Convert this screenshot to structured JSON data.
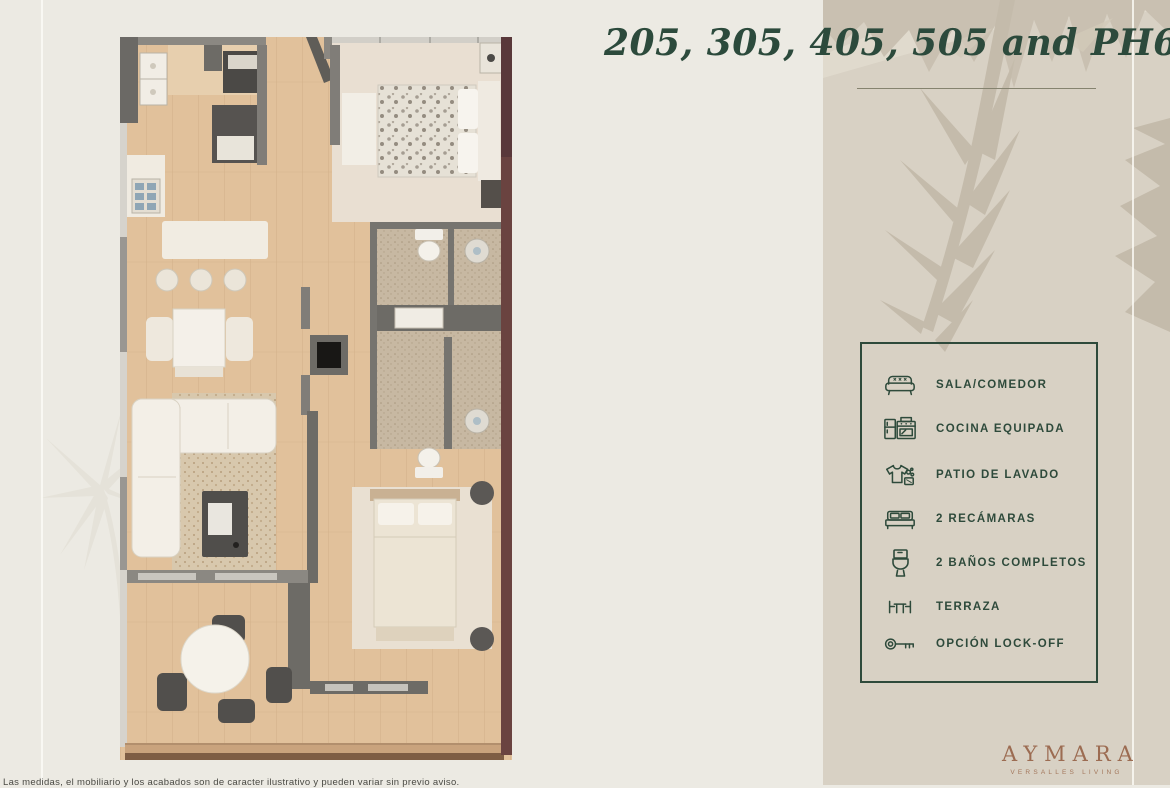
{
  "page": {
    "title": "205, 305, 405, 505 and PH605",
    "footer_note": "Las medidas, el mobiliario y los acabados son de caracter ilustrativo y pueden variar sin previo aviso."
  },
  "features": {
    "items": [
      {
        "name": "sala-comedor",
        "icon": "sofa-icon",
        "label": "SALA/COMEDOR"
      },
      {
        "name": "cocina-equipada",
        "icon": "kitchen-icon",
        "label": "COCINA EQUIPADA"
      },
      {
        "name": "patio-de-lavado",
        "icon": "laundry-icon",
        "label": "PATIO DE LAVADO"
      },
      {
        "name": "dos-recamaras",
        "icon": "bed-icon",
        "label": "2 RECÁMARAS"
      },
      {
        "name": "dos-banos",
        "icon": "toilet-icon",
        "label": "2 BAÑOS COMPLETOS"
      },
      {
        "name": "terraza",
        "icon": "terrace-table-icon",
        "label": "TERRAZA"
      },
      {
        "name": "opcion-lock-off",
        "icon": "key-icon",
        "label": "OPCIÓN LOCK-OFF"
      }
    ]
  },
  "brand": {
    "name": "AYMARA",
    "tagline": "VERSALLES LIVING"
  },
  "floorplan": {
    "description": "Top-view rendered floor plan: kitchen, living/dining, two bedrooms, two bathrooms, laundry patio and terrace"
  },
  "colors": {
    "accent_green": "#2E4A3B",
    "brand_brown": "#9C6C52",
    "left_background": "#ECEAE3",
    "right_background": "#D8D1C4"
  }
}
